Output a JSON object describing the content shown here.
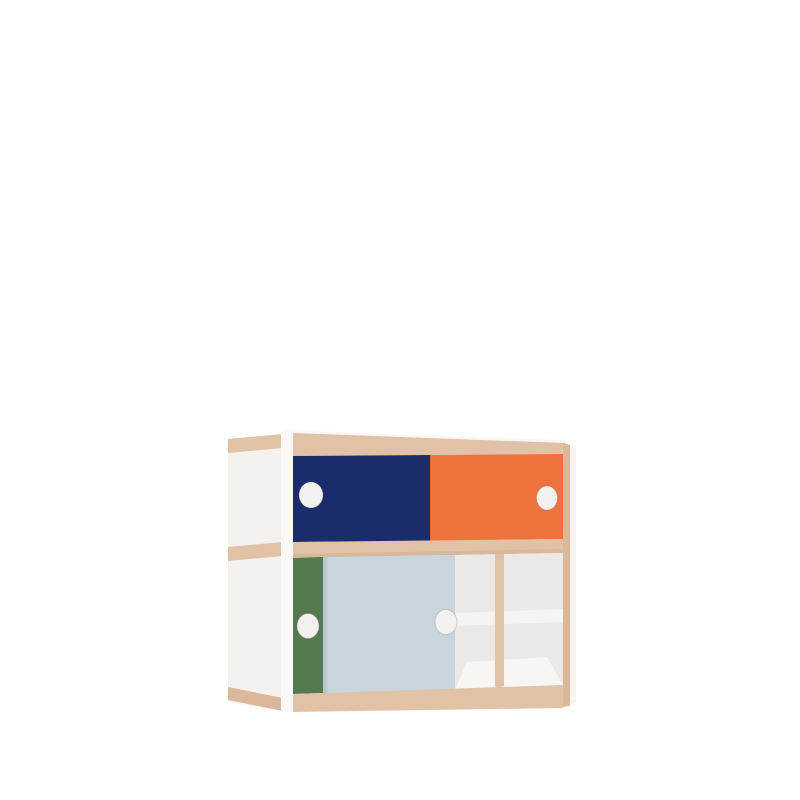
{
  "scene": {
    "description": "3D product render of a two-tier cabinet with sliding doors, white frame with exposed plywood edges, on a plain white background",
    "background_color": "#FFFFFF"
  },
  "colors": {
    "background": "#FFFFFF",
    "side_panel": "#F4F1EE",
    "front_post": "#FAF9F7",
    "top_highlight": "#F8F7F5",
    "plywood": "#E2C2A6",
    "plywood_dark": "#DBB899",
    "navy": "#1A2C6B",
    "orange": "#ED723C",
    "green": "#567A50",
    "light_blue": "#C9D5DD",
    "interior_back": "#EBE8E5",
    "interior_floor": "#F8F6F3",
    "shelf_white": "#F6F4F1",
    "right_sliver": "#F6F4F2",
    "handle_white": "#F3F1EF"
  },
  "cabinet": {
    "frame": "white panels with exposed plywood band edges (top, middle, bottom) and plywood right front edge",
    "tiers": [
      {
        "position": "top",
        "doors": [
          {
            "id": "top-left",
            "color_name": "navy",
            "handle": "round white cutout"
          },
          {
            "id": "top-right",
            "color_name": "orange",
            "handle": "round white cutout"
          }
        ]
      },
      {
        "position": "bottom",
        "doors": [
          {
            "id": "bottom-left",
            "color_name": "green",
            "handle": "round white cutout",
            "note": "mostly hidden behind light blue door"
          },
          {
            "id": "bottom-middle",
            "color_name": "light_blue",
            "handle": "round white cutout"
          }
        ],
        "open_compartment": {
          "divider": "vertical plywood-edged divider",
          "shelf": "white mid-height shelf",
          "interior": "white/light gray back and floor"
        }
      }
    ]
  }
}
